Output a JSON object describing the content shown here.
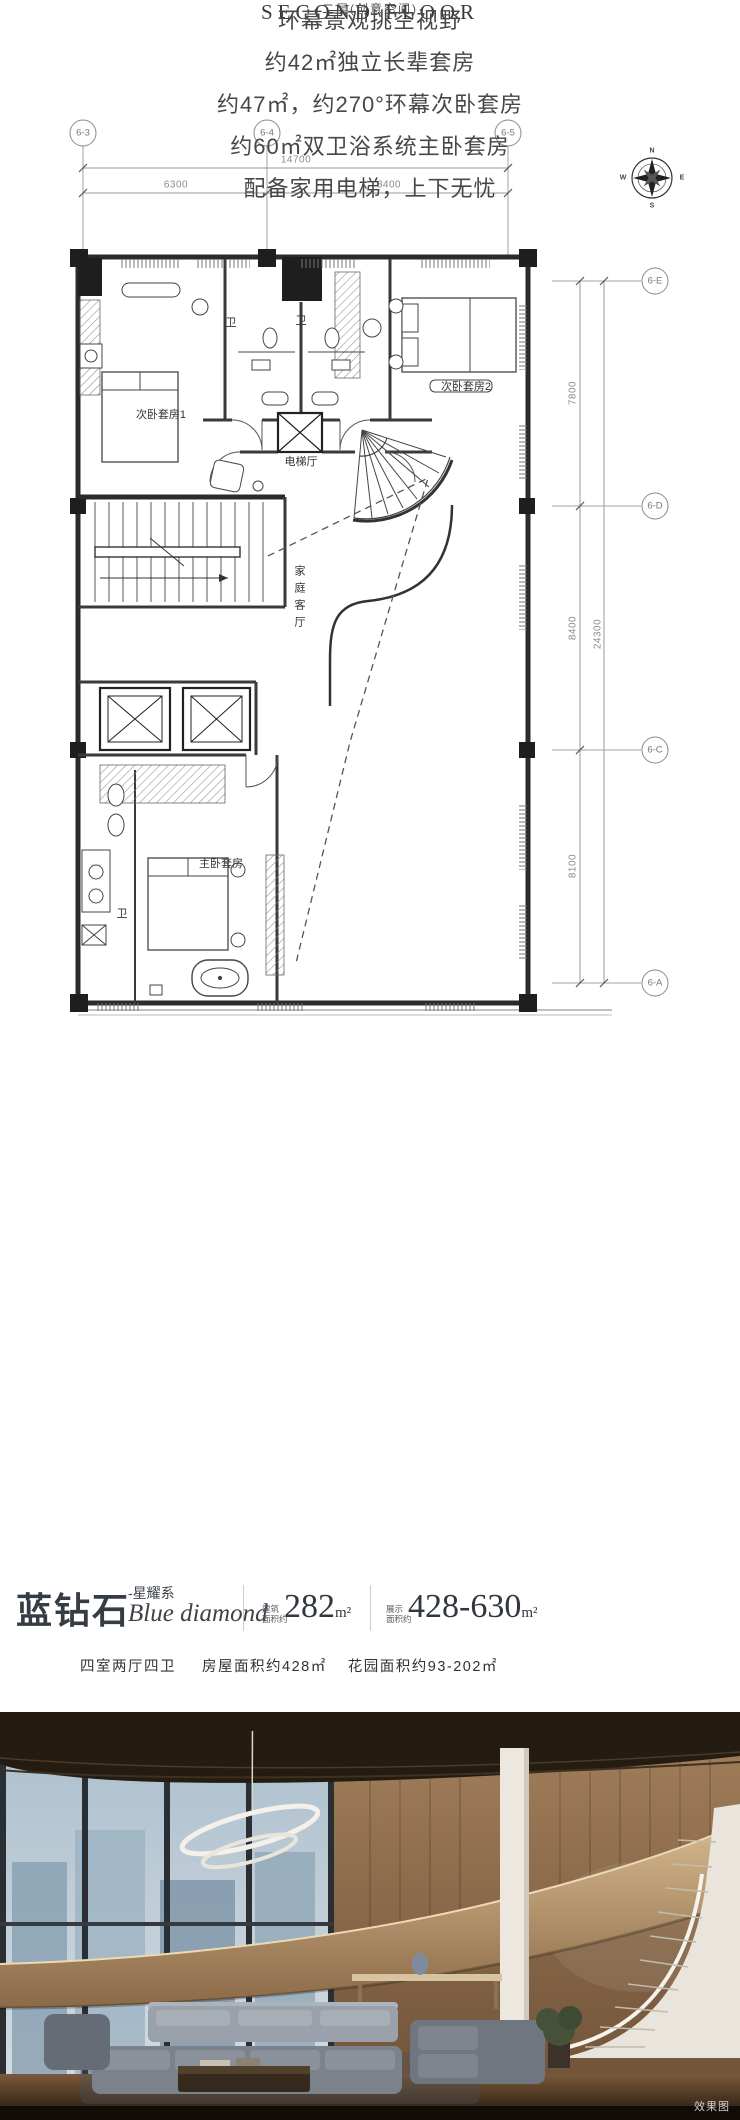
{
  "plan": {
    "grid_cols": {
      "c1": "6-3",
      "c2": "6-4",
      "c3": "6-5"
    },
    "grid_rows": {
      "rE": "6-E",
      "rD": "6-D",
      "rC": "6-C",
      "rA": "6-A"
    },
    "dims": {
      "top_total": "14700",
      "top_seg1": "6300",
      "top_seg2": "8400",
      "right_seg1": "7800",
      "right_seg2": "8400",
      "right_seg3": "8100",
      "right_total": "24300"
    },
    "compass": {
      "n": "N",
      "e": "E",
      "s": "S",
      "w": "W"
    },
    "rooms": {
      "bedroom1": "次卧套房1",
      "bedroom2": "次卧套房2",
      "bath1": "卫",
      "bath2": "卫",
      "elevator_hall": "电梯厅",
      "family_room": "家庭客厅",
      "master": "主卧套房",
      "master_bath": "卫"
    },
    "title_en": "SECOND FLOOR",
    "title_cn": "二层(创意空间)"
  },
  "features": {
    "line1": "环幕景观挑空视野",
    "line2": "约42㎡独立长辈套房",
    "line3": "约47㎡，约270°环幕次卧套房",
    "line4": "约60㎡双卫浴系统主卧套房",
    "line5": "配备家用电梯，上下无忧"
  },
  "brand": {
    "name": "蓝钻石",
    "series": "-星耀系",
    "name_en": "Blue diamond",
    "metric1_label1": "建筑",
    "metric1_label2": "面积约",
    "metric1_value": "282",
    "metric1_unit": "m²",
    "metric2_label1": "展示",
    "metric2_label2": "面积约",
    "metric2_value": "428-630",
    "metric2_unit": "m²",
    "layout": "四室两厅四卫",
    "area_house": "房屋面积约428㎡",
    "area_garden": "花园面积约93-202㎡"
  },
  "photo": {
    "watermark": "效果图"
  },
  "colors": {
    "ink": "#363c43",
    "plan_line": "#2b2b2b",
    "dim_line": "#999999"
  }
}
